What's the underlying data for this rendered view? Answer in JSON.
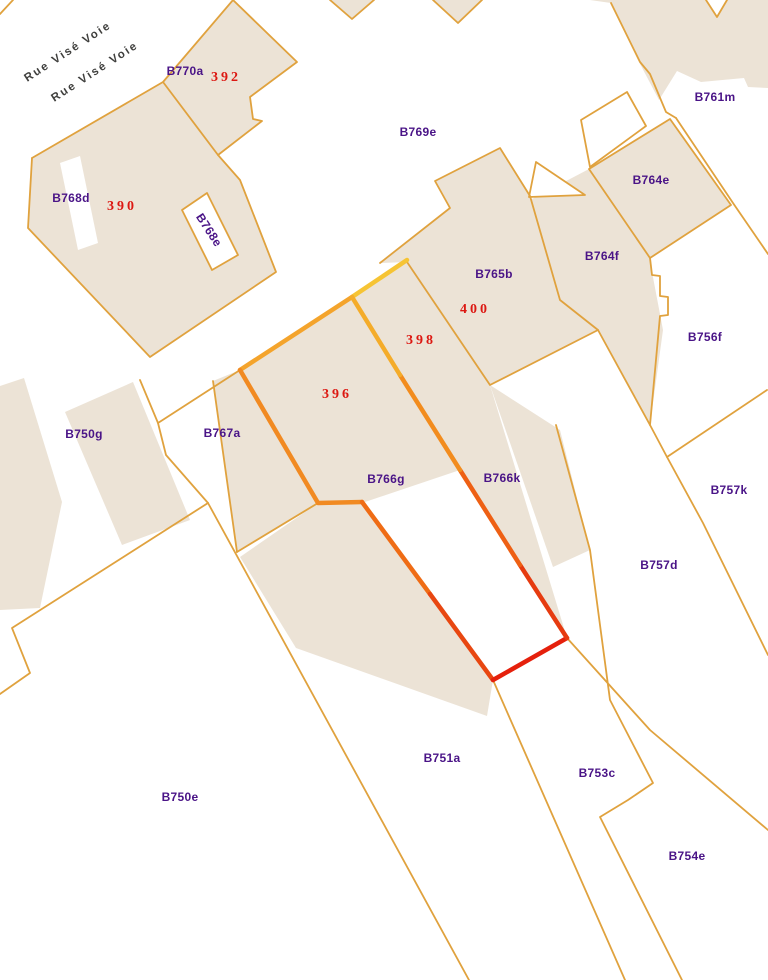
{
  "map": {
    "title": "cadastral-parcel-map",
    "street_labels": [
      {
        "text": "Rue Visé Voie",
        "x": 68,
        "y": 52,
        "rot": -33
      },
      {
        "text": "Rue Visé Voie",
        "x": 95,
        "y": 72,
        "rot": -33
      }
    ],
    "parcel_labels": [
      {
        "id": "B770a",
        "x": 185,
        "y": 71,
        "rot": 0
      },
      {
        "id": "B768d",
        "x": 71,
        "y": 198,
        "rot": 0
      },
      {
        "id": "B768e",
        "x": 209,
        "y": 230,
        "rot": 57
      },
      {
        "id": "B769e",
        "x": 418,
        "y": 132,
        "rot": 0
      },
      {
        "id": "B761m",
        "x": 715,
        "y": 97,
        "rot": 0
      },
      {
        "id": "B764e",
        "x": 651,
        "y": 180,
        "rot": 0
      },
      {
        "id": "B764f",
        "x": 602,
        "y": 256,
        "rot": 0
      },
      {
        "id": "B765b",
        "x": 494,
        "y": 274,
        "rot": 0
      },
      {
        "id": "B756f",
        "x": 705,
        "y": 337,
        "rot": 0
      },
      {
        "id": "B767a",
        "x": 222,
        "y": 433,
        "rot": 0
      },
      {
        "id": "B750g",
        "x": 84,
        "y": 434,
        "rot": 0
      },
      {
        "id": "B766g",
        "x": 386,
        "y": 479,
        "rot": 0
      },
      {
        "id": "B766k",
        "x": 502,
        "y": 478,
        "rot": 0
      },
      {
        "id": "B757k",
        "x": 729,
        "y": 490,
        "rot": 0
      },
      {
        "id": "B757d",
        "x": 659,
        "y": 565,
        "rot": 0
      },
      {
        "id": "B751a",
        "x": 442,
        "y": 758,
        "rot": 0
      },
      {
        "id": "B753c",
        "x": 597,
        "y": 773,
        "rot": 0
      },
      {
        "id": "B750e",
        "x": 180,
        "y": 797,
        "rot": 0
      },
      {
        "id": "B754e",
        "x": 687,
        "y": 856,
        "rot": 0
      }
    ],
    "house_numbers": [
      {
        "value": "392",
        "x": 226,
        "y": 78
      },
      {
        "value": "390",
        "x": 122,
        "y": 207
      },
      {
        "value": "400",
        "x": 475,
        "y": 310
      },
      {
        "value": "398",
        "x": 421,
        "y": 341
      },
      {
        "value": "396",
        "x": 337,
        "y": 395
      }
    ],
    "colors": {
      "parcel_fill": "#ECE3D6",
      "boundary_line": "#E0A23E",
      "parcel_label_text": "#4A1487",
      "house_number_text": "#DC1812",
      "street_text": "#3F3F3D",
      "highlight_yellow": "#F6C434",
      "highlight_orange": "#F18A22",
      "highlight_red": "#E5200C",
      "background": "#FFFFFF"
    }
  }
}
